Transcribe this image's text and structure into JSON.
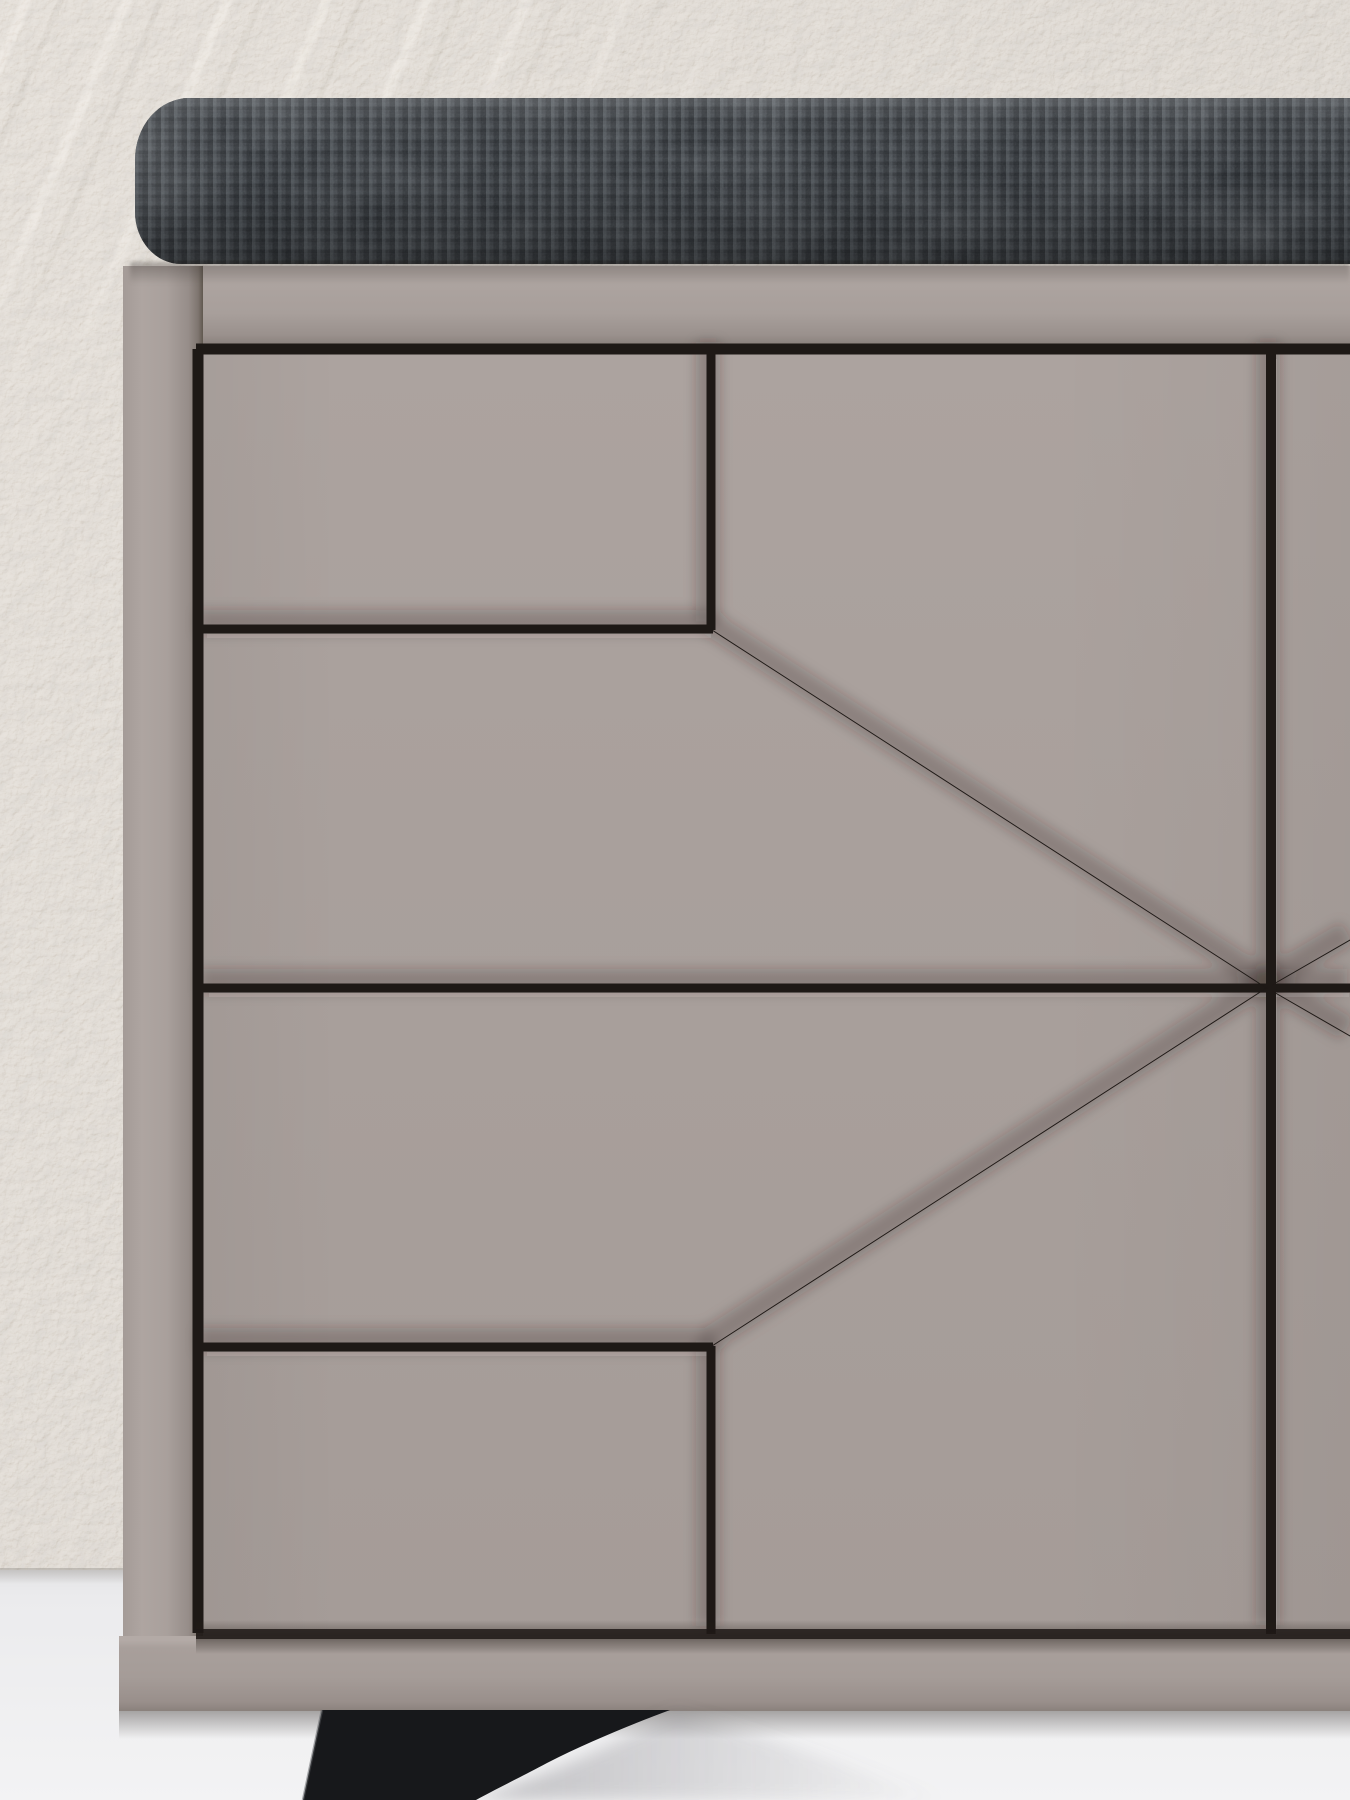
{
  "scene": {
    "type": "furniture-product-photo",
    "subject": "Modern sideboard shoe bench, close-up front view",
    "setting": "textured beige plaster wall with diagonal trowel strokes, white floor",
    "description": "Taupe-grey cabinet with black V-groove star pattern routed into the door and drawer fronts; grooves radiate from a hub near the right edge; stack of four drawer fronts on the left; dark charcoal woven boucle seat cushion with rounded left end rests on top; black angled fin-shaped front leg below the plinth."
  },
  "objects": [
    {
      "name": "plaster-wall",
      "detail": "beige stucco texture, lighter diagonal trowel streaks in upper left"
    },
    {
      "name": "seat-cushion",
      "detail": "dark charcoal woven fabric pad, rounded left corners, spans to right edge"
    },
    {
      "name": "cabinet-top-frame",
      "detail": "taupe top rail under the cushion"
    },
    {
      "name": "cabinet-left-frame",
      "detail": "taupe left side rail"
    },
    {
      "name": "door-drawer-panels",
      "detail": "flat taupe fronts separated by deep dark grooves"
    },
    {
      "name": "groove-star-pattern",
      "detail": "horizontal, vertical and diagonal grooves meeting at a star hub"
    },
    {
      "name": "plinth",
      "detail": "taupe base rail"
    },
    {
      "name": "front-leg",
      "detail": "black fin-shaped angled leg"
    },
    {
      "name": "floor",
      "detail": "white floor with soft contact shadows"
    }
  ],
  "colors": {
    "wall": "#d7d0c7",
    "wall_streak": "#ece5db",
    "floor": "#ebebed",
    "floor_bright": "#f3f3f4",
    "cabinet_face": "#a9a09c",
    "cabinet_face_light": "#b4aba7",
    "cabinet_shade": "#8e8581",
    "plinth": "#a59c98",
    "groove": "#1e1916",
    "cushion": "#3c4045",
    "cushion_highlight": "#5a6066",
    "cushion_shadow": "#24282c",
    "leg": "#17181b",
    "floor_shadow": "#c6c6ca"
  }
}
